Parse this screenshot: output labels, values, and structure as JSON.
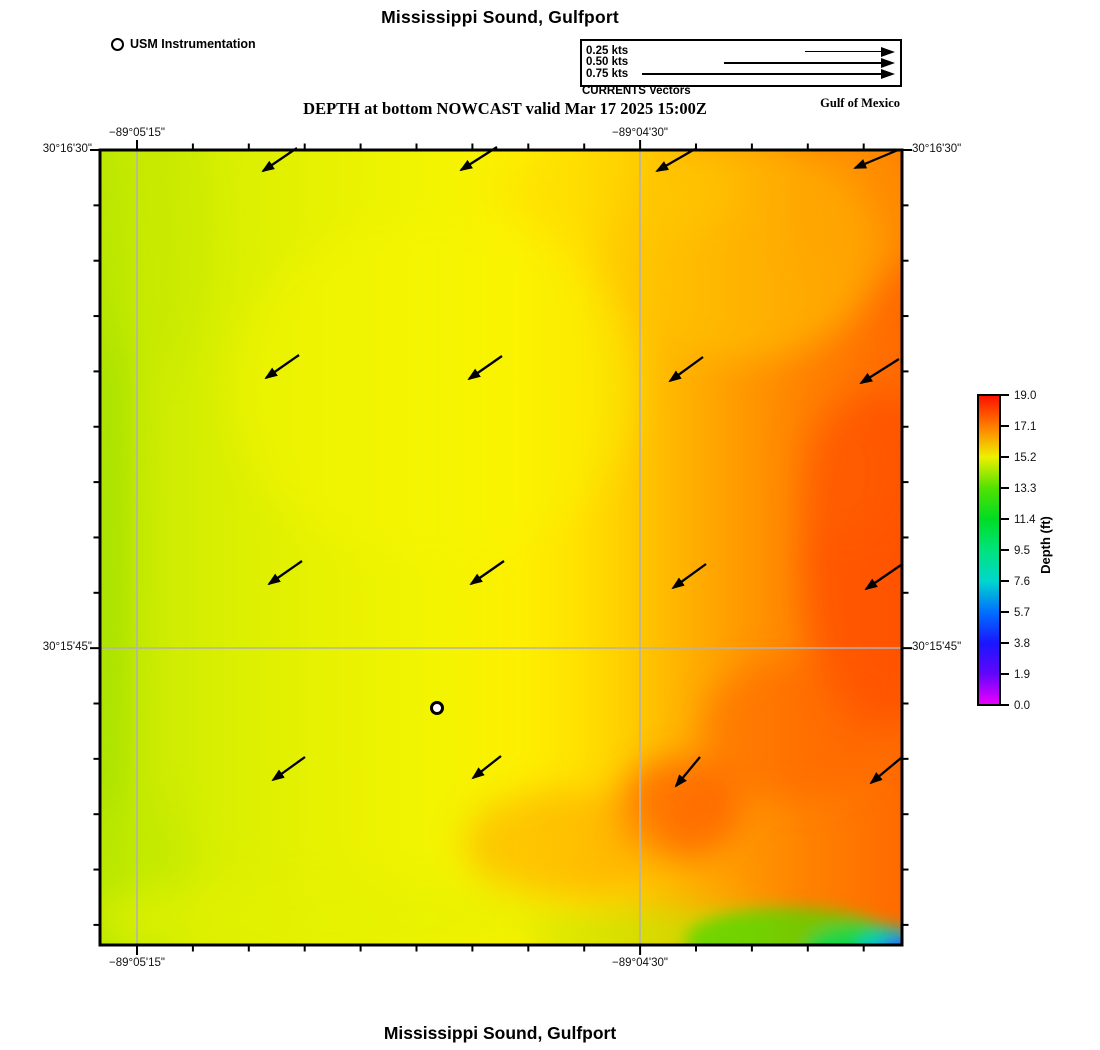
{
  "header": {
    "title": "Mississippi Sound, Gulfport",
    "subtitle": "DEPTH at bottom NOWCAST valid Mar 17 2025 15:00Z",
    "region_label": "Gulf of Mexico",
    "instrumentation": {
      "label": "USM Instrumentation",
      "marker": "open-circle"
    },
    "vector_legend": {
      "caption": "CURRENTS Vectors",
      "line_end_x": 893,
      "entries": [
        {
          "label": "0.25 kts",
          "speed_kts": 0.25,
          "line_start_x": 803
        },
        {
          "label": "0.50 kts",
          "speed_kts": 0.5,
          "line_start_x": 722
        },
        {
          "label": "0.75 kts",
          "speed_kts": 0.75,
          "line_start_x": 640
        }
      ]
    }
  },
  "footer": {
    "title": "Mississippi Sound, Gulfport"
  },
  "map": {
    "frame": {
      "left": 100,
      "top": 150,
      "right": 902,
      "bottom": 945
    },
    "grid_color": "#b2b2b2",
    "lon_ticks": [
      {
        "label": "−89°05'15\"",
        "x": 137
      },
      {
        "label": "−89°04'30\"",
        "x": 640
      }
    ],
    "lat_ticks": [
      {
        "label": "30°16'30\"",
        "y": 150
      },
      {
        "label": "30°15'45\"",
        "y": 648
      }
    ],
    "minor_tick_step_x": 55.9,
    "minor_tick_step_y": 55.35,
    "station_marker": {
      "x": 437,
      "y": 708,
      "name": "USM Instrumentation station"
    },
    "current_arrows": [
      {
        "x1": 297,
        "y1": 148,
        "x2": 263,
        "y2": 171
      },
      {
        "x1": 497,
        "y1": 147,
        "x2": 461,
        "y2": 170
      },
      {
        "x1": 695,
        "y1": 149,
        "x2": 657,
        "y2": 171
      },
      {
        "x1": 898,
        "y1": 150,
        "x2": 855,
        "y2": 168
      },
      {
        "x1": 299,
        "y1": 355,
        "x2": 266,
        "y2": 378
      },
      {
        "x1": 502,
        "y1": 356,
        "x2": 469,
        "y2": 379
      },
      {
        "x1": 703,
        "y1": 357,
        "x2": 670,
        "y2": 381
      },
      {
        "x1": 899,
        "y1": 359,
        "x2": 861,
        "y2": 383
      },
      {
        "x1": 302,
        "y1": 561,
        "x2": 269,
        "y2": 584
      },
      {
        "x1": 504,
        "y1": 561,
        "x2": 471,
        "y2": 584
      },
      {
        "x1": 706,
        "y1": 564,
        "x2": 673,
        "y2": 588
      },
      {
        "x1": 901,
        "y1": 565,
        "x2": 866,
        "y2": 589
      },
      {
        "x1": 305,
        "y1": 757,
        "x2": 273,
        "y2": 780
      },
      {
        "x1": 501,
        "y1": 756,
        "x2": 473,
        "y2": 778
      },
      {
        "x1": 700,
        "y1": 757,
        "x2": 676,
        "y2": 786
      },
      {
        "x1": 901,
        "y1": 758,
        "x2": 871,
        "y2": 783
      }
    ]
  },
  "colorbar": {
    "label": "Depth (ft)",
    "min": 0.0,
    "max": 19.0,
    "ticks": [
      "19.0",
      "17.1",
      "15.2",
      "13.3",
      "11.4",
      "9.5",
      "7.6",
      "5.7",
      "3.8",
      "1.9",
      "0.0"
    ],
    "gradient_stops": [
      {
        "offset": 0,
        "color": "#fb0f00"
      },
      {
        "offset": 10,
        "color": "#ff7c00"
      },
      {
        "offset": 20,
        "color": "#eef000"
      },
      {
        "offset": 30,
        "color": "#52e200"
      },
      {
        "offset": 40,
        "color": "#00dd25"
      },
      {
        "offset": 50,
        "color": "#00e37c"
      },
      {
        "offset": 60,
        "color": "#00d7cd"
      },
      {
        "offset": 70,
        "color": "#0070ff"
      },
      {
        "offset": 80,
        "color": "#1a16ff"
      },
      {
        "offset": 90,
        "color": "#6306fa"
      },
      {
        "offset": 100,
        "color": "#ee00ff"
      }
    ]
  },
  "chart_data": {
    "type": "heatmap",
    "title": "Mississippi Sound, Gulfport",
    "subtitle": "DEPTH at bottom NOWCAST valid Mar 17 2025 15:00Z",
    "x_axis": {
      "tick_labels": [
        "−89°05'15\"",
        "−89°04'30\""
      ]
    },
    "y_axis": {
      "tick_labels": [
        "30°16'30\"",
        "30°15'45\""
      ]
    },
    "colorbar": {
      "label": "Depth (ft)",
      "range": [
        0.0,
        19.0
      ],
      "tick_values": [
        19.0,
        17.1,
        15.2,
        13.3,
        11.4,
        9.5,
        7.6,
        5.7,
        3.8,
        1.9,
        0.0
      ]
    },
    "grid": "on",
    "legend_position": "top",
    "depth_grid_ft_estimated": {
      "note": "approximate values read from color field; rows north to south, columns west to east",
      "rows": [
        [
          14.6,
          15.0,
          15.4,
          16.4,
          17.4
        ],
        [
          14.6,
          15.1,
          15.7,
          16.9,
          17.9
        ],
        [
          14.4,
          15.2,
          16.1,
          17.6,
          18.4
        ],
        [
          14.3,
          15.4,
          16.6,
          18.1,
          18.6
        ],
        [
          13.9,
          14.9,
          15.6,
          13.5,
          4.5
        ]
      ]
    },
    "vectors": {
      "units": "kts",
      "reference_speeds": [
        0.25,
        0.5,
        0.75
      ],
      "grid": "4 x 4 arrows",
      "approx_direction": "southwest"
    },
    "station_markers": [
      {
        "name": "USM Instrumentation",
        "symbol": "open-circle"
      }
    ]
  }
}
